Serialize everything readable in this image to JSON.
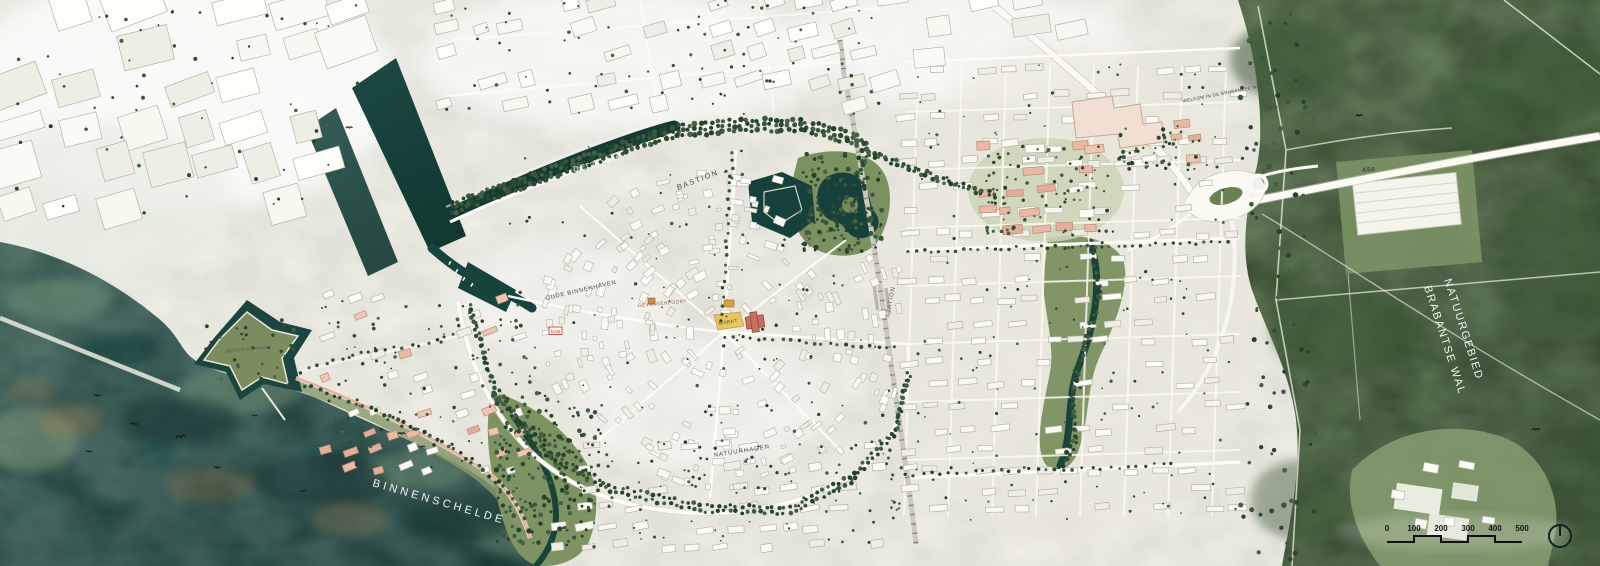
{
  "map": {
    "place_labels": {
      "de_zoom": "DE ZOOM",
      "bastion": "BASTION",
      "ravelijn": "RAVELIJN",
      "oude_binnenhaven": "OUDE BINNENHAVEN",
      "gevangenpoort": "GEVANGENPOORT",
      "markt": "MARKT",
      "dab": "DAB",
      "station": "STATION",
      "natuurhagen": "NATUURHAGEN",
      "waterschans": "WATERSCHANS",
      "binnenschelde": "BINNENSCHELDE",
      "welkom_in_de_brabantse_wal": "\"WELKOM IN DE BRABANTSE WAL\"",
      "a58": "A58",
      "natuurgebied": "NATUURGEBIED",
      "brabantse_wal": "BRABANTSE WAL"
    },
    "scale_bar": {
      "unit_values": [
        "0",
        "100",
        "200",
        "300",
        "400",
        "500"
      ]
    },
    "compass": {
      "type": "north-circle"
    },
    "colors": {
      "water_deep": "#123a35",
      "water_lake": "#2e5a4f",
      "forest": "#4d6a43",
      "park": "#7d9263",
      "city_base": "#f0efe6",
      "building_white": "#fcfcf8",
      "development_pink": "#e9bca9",
      "landmark_orange": "#e2c04f",
      "landmark_red": "#c96f5f",
      "road_white": "#fbfaf4"
    }
  }
}
